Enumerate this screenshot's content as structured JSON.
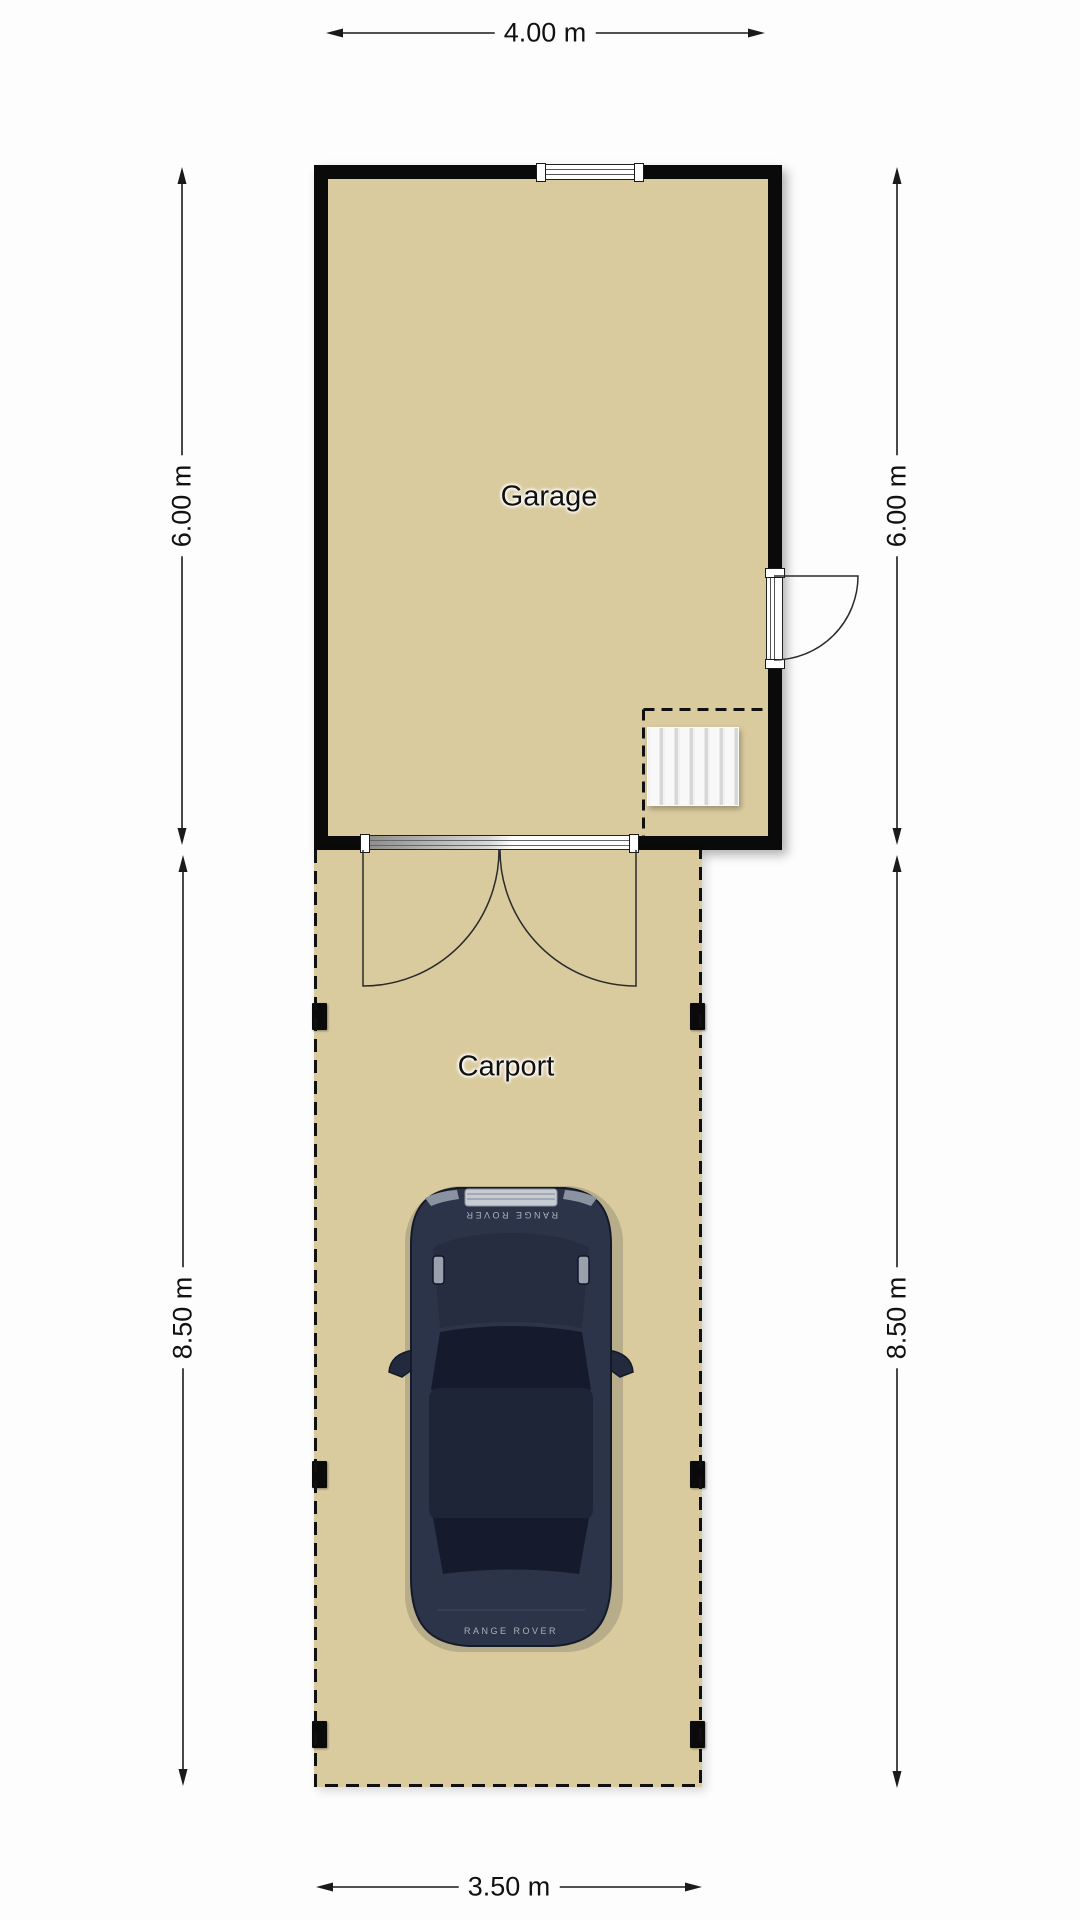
{
  "rooms": {
    "garage": {
      "label": "Garage"
    },
    "carport": {
      "label": "Carport"
    }
  },
  "dimensions": {
    "garage_width": "4.00 m",
    "garage_height_left": "6.00 m",
    "garage_height_right": "6.00 m",
    "carport_height_left": "8.50 m",
    "carport_height_right": "8.50 m",
    "carport_width": "3.50 m"
  },
  "car": {
    "brand_text": "RANGE ROVER"
  },
  "colors": {
    "floor": "#d9cb9e",
    "wall": "#0a0a0a",
    "line": "#1a1a1a",
    "car-body": "#2c3449",
    "car-hood": "#262d41",
    "car-glass": "#151b2c",
    "car-roof": "#1e2537"
  }
}
